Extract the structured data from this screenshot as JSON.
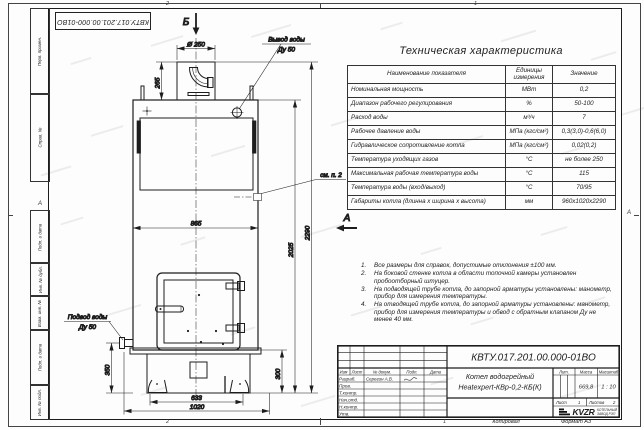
{
  "sheet": {
    "stamp_top": "КВТУ.017.201.00.000-01ВО",
    "zones": {
      "top_left": "2",
      "top_right": "1",
      "bottom_left": "2",
      "bottom_right": "1",
      "side_left": "А",
      "side_right": "А"
    },
    "margin_labels": [
      "Перв. примен.",
      "Справ. №",
      "Подп. и дата",
      "Инв. № дубл.",
      "Взам. инв. №",
      "Подп. и дата",
      "Инв. № подл."
    ],
    "footer": {
      "copied": "Копировал",
      "format": "Формат А3"
    }
  },
  "drawing": {
    "section_label": "Б",
    "view_label": "А",
    "outlet_label_1": "Вывод воды",
    "outlet_label_2": "Ду 50",
    "inlet_label_1": "Подвод воды",
    "inlet_label_2": "Ду 50",
    "see_note": "см. п. 2",
    "dims": {
      "chimney_dia": "Ø 250",
      "chimney_h": "265",
      "body_w": "865",
      "total_h": "2290",
      "body_h": "2025",
      "inlet_h": "350",
      "base_h": "300",
      "base_w": "633",
      "depth": "1020"
    }
  },
  "spec_table": {
    "title": "Техническая характеристика",
    "col_name": "Наименование показателя",
    "col_units": "Единицы измерения",
    "col_value": "Значение",
    "rows": [
      {
        "name": "Номинальная мощность",
        "units": "МВт",
        "value": "0,2"
      },
      {
        "name": "Диапазон рабочего регулирования",
        "units": "%",
        "value": "50-100"
      },
      {
        "name": "Расход воды",
        "units": "м³/ч",
        "value": "7"
      },
      {
        "name": "Рабочее давление воды",
        "units": "МПа (кгс/см²)",
        "value": "0,3(3,0)-0,6(6,0)"
      },
      {
        "name": "Гидравлическое сопротивление котла",
        "units": "МПа (кгс/см²)",
        "value": "0,02(0,2)"
      },
      {
        "name": "Температура уходящих газов",
        "units": "°С",
        "value": "не более 250"
      },
      {
        "name": "Максимальная рабочая температура воды",
        "units": "°С",
        "value": "115"
      },
      {
        "name": "Температура воды (вход/выход)",
        "units": "°С",
        "value": "70/95"
      },
      {
        "name": "Габариты котла (длинна x ширина x высота)",
        "units": "мм",
        "value": "960x1020x2290"
      }
    ]
  },
  "notes": {
    "items": [
      {
        "n": "1.",
        "text": "Все размеры для справок, допустимые отклонения ±100 мм."
      },
      {
        "n": "2.",
        "text": "На боковой стенке котла в области топочной камеры установлен пробоотборный штуцер."
      },
      {
        "n": "3.",
        "text": "На подводящей трубе котла, до запорной арматуры установлены: манометр, прибор для измерения температуры."
      },
      {
        "n": "4.",
        "text": "На отводящей трубе котла, до запорной арматуры установлены: манометр, прибор для измерения температуры и обвод с обратным клапаном Ду не менее 40 мм."
      }
    ]
  },
  "title_block": {
    "doc_number": "КВТУ.017.201.00.000-01ВО",
    "product_1": "Котел водогрейный",
    "product_2": "Heatexpert-КВр-0,2-КБ(К)",
    "cols": {
      "izm": "Изм",
      "list": "Лист",
      "doc": "№ докум.",
      "sign": "Подп.",
      "date": "Дата"
    },
    "roles": [
      "Разраб.",
      "Пров.",
      "Т.контр.",
      "Нач.отд.",
      "Н.контр.",
      "Утв."
    ],
    "developer": "Серегин А.В.",
    "lit_label": "Лит.",
    "mass_label": "Масса",
    "scale_label": "Масштаб",
    "mass": "669,8",
    "scale": "1 : 10",
    "sheet_label": "Лист",
    "sheet_value": "1",
    "sheets_label": "Листов",
    "sheets_value": "2",
    "logo_text": "KVZR",
    "company_1": "КОТЕЛЬНЫЙ",
    "company_2": "ЗАВОД РЭП"
  }
}
